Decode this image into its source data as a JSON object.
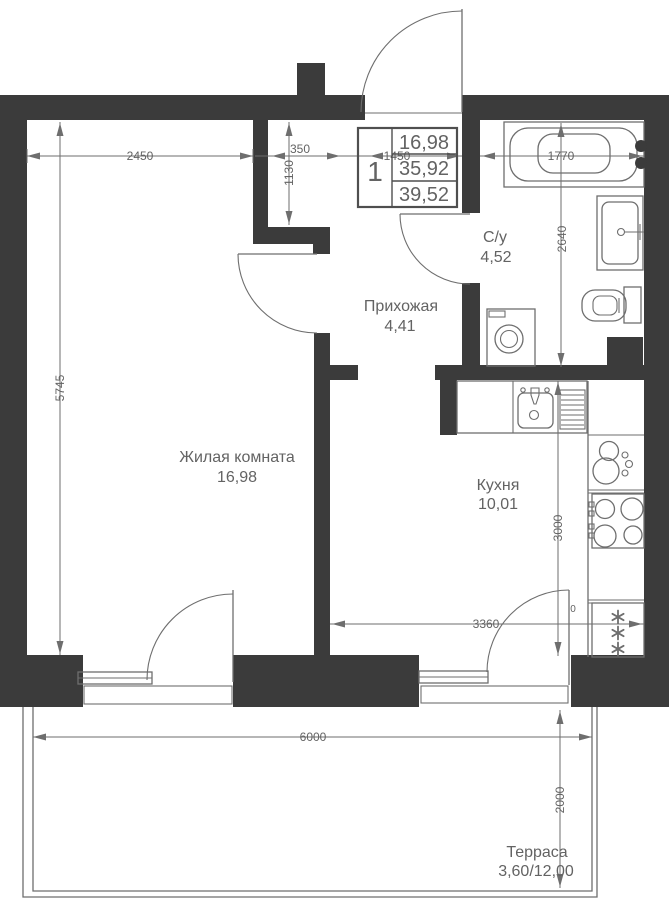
{
  "stamp": {
    "rooms_count": "1",
    "living_area": "16,98",
    "apartment_area": "35,92",
    "total_area": "39,52"
  },
  "rooms": {
    "living": {
      "name": "Жилая комната",
      "area": "16,98"
    },
    "hall": {
      "name": "Прихожая",
      "area": "4,41"
    },
    "kitchen": {
      "name": "Кухня",
      "area": "10,01"
    },
    "bathroom": {
      "name": "С/у",
      "area": "4,52"
    },
    "terrace": {
      "name": "Терраса",
      "area": "3,60/12,00"
    }
  },
  "dimensions": {
    "d2450": "2450",
    "d350": "350",
    "d1450": "1450",
    "d1770": "1770",
    "d1130": "1130",
    "d5745": "5745",
    "d2640": "2640",
    "d3000": "3000",
    "d3360": "3360",
    "d6000": "6000",
    "d2000": "2000",
    "zero": "0"
  },
  "colors": {
    "wall": "#3b3b3b",
    "line": "#6e6e6e",
    "text": "#636363",
    "background": "#ffffff"
  }
}
